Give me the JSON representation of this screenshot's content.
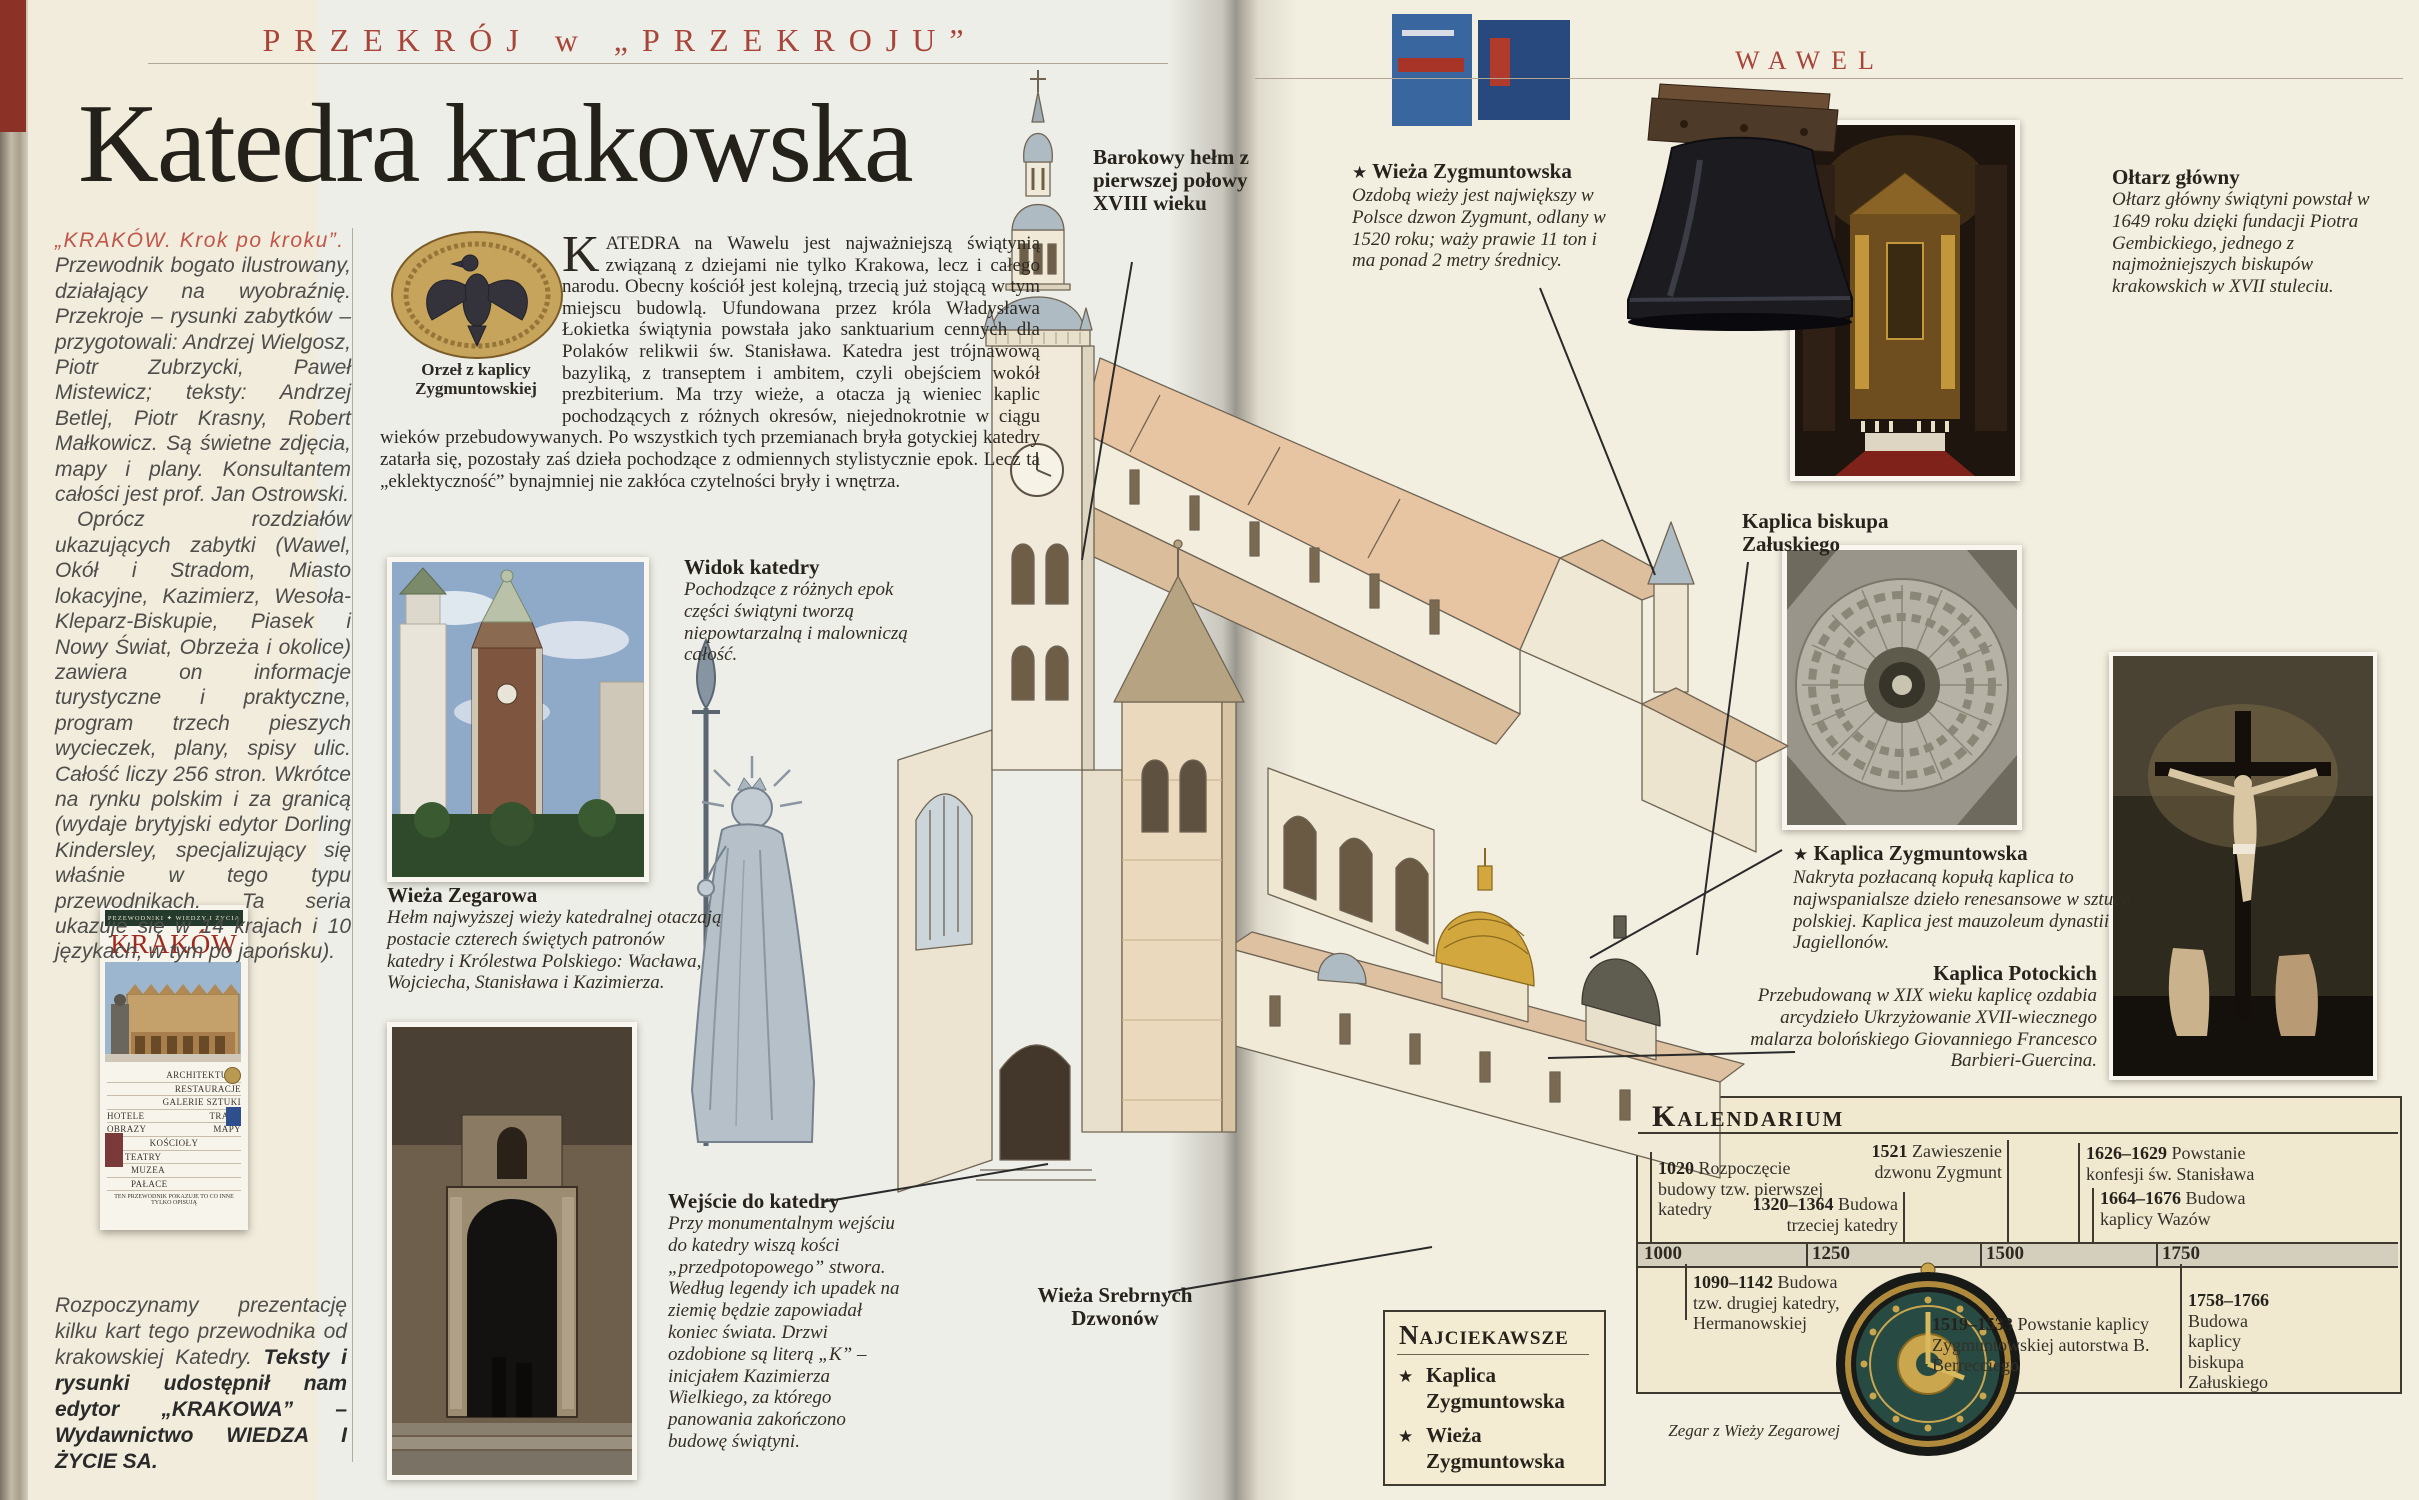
{
  "colors": {
    "masthead_red": "#a8453a",
    "lead_red": "#c0574a",
    "gold_dome": "#d2a83e",
    "kal_bg": "#f0e9d0"
  },
  "masthead": {
    "left": "PRZEKRÓJ w „PRZEKROJU”",
    "right": "WAWEL"
  },
  "title": "Katedra krakowska",
  "review": {
    "lead": "„KRAKÓW. Krok po kroku”.",
    "para1": "Przewodnik bogato ilustrowany, działający na wyobraźnię. Przekroje – rysunki zabytków – przygotowali: Andrzej Wielgosz, Piotr Zubrzycki, Paweł Mistewicz; teksty: Andrzej Betlej, Piotr Krasny, Robert Małkowicz. Są świetne zdjęcia, mapy i plany. Konsultantem całości jest prof. Jan Ostrowski.",
    "para2": "Oprócz rozdziałów ukazujących zabytki (Wawel, Okół i Stradom, Miasto lokacyjne, Kazimierz, Wesoła-Kleparz-Biskupie, Piasek i Nowy Świat, Obrzeża i okolice) zawiera on informacje turystyczne i praktyczne, program trzech pieszych wycieczek, plany, spisy ulic. Całość liczy 256 stron. Wkrótce na rynku polskim i za granicą (wydaje brytyjski edytor Dorling Kindersley, specjalizujący się właśnie w tego typu przewodnikach. Ta seria ukazuje się w 14 krajach i 10 językach, w tym po japońsku).",
    "footer_plain": "Rozpoczynamy prezentację kilku kart tego przewodnika od krakowskiej Katedry. ",
    "footer_bold": "Teksty i rysunki udostępnił nam edytor „KRAKOWA” – Wydawnictwo WIEDZA I ŻYCIE SA."
  },
  "cover": {
    "series": "PRZEWODNIKI ✦ WIEDZY I ŻYCIA",
    "title": "KRAKÓW",
    "keywords": [
      "ARCHITEKTURA",
      "RESTAURACJE",
      "GALERIE SZTUKI",
      "HOTELE",
      "TRASY",
      "OBRAZY",
      "MAPY",
      "KOŚCIOŁY",
      "TEATRY",
      "MUZEA",
      "PAŁACE"
    ],
    "tagline": "TEN PRZEWODNIK POKAZUJE TO CO INNE TYLKO OPISUJĄ"
  },
  "intro": {
    "dropcap": "K",
    "text": "ATEDRA na Wawelu jest najważniejszą świątynią związaną z dziejami nie tylko Krakowa, lecz i całego narodu. Obecny kościół jest kolejną, trzecią już stojącą w tym miejscu budowlą. Ufundowana przez króla Władysława Łokietka świątynia powstała jako sanktuarium cennych dla Polaków relikwii św. Stanisława. Katedra jest trójnawową bazyliką, z transeptem i ambitem, czyli obejściem wokół prezbiterium. Ma trzy wieże, a otacza ją wieniec kaplic pochodzących z różnych okresów, niejednokrotnie w ciągu wieków przebudowywanych. Po wszystkich tych przemianach bryła gotyckiej katedry zatarła się, pozostały zaś dzieła pochodzące z odmiennych stylistycznie epok. Lecz ta „eklektyczność” bynajmniej nie zakłóca czytelności bryły i wnętrza."
  },
  "star": "★",
  "captions": {
    "eagle": "Orzeł z kaplicy Zygmuntowskiej",
    "widok": {
      "title": "Widok katedry",
      "body": "Pochodzące z różnych epok części świątyni tworzą niepowtarzalną i malowniczą całość."
    },
    "wieza_zegarowa": {
      "title": "Wieża Zegarowa",
      "body": "Hełm najwyższej wieży katedralnej otaczają postacie czterech świętych patronów katedry i Królestwa Polskiego: Wacława, Wojciecha, Stanisława i Kazimierza."
    },
    "wejscie": {
      "title": "Wejście do katedry",
      "body": "Przy monumentalnym wejściu do katedry wiszą kości „przedpotopowego” stwora. Według legendy ich upadek na ziemię będzie zapowiadał koniec świata. Drzwi ozdobione są literą „K” – inicjałem Kazimierza Wielkiego, za którego panowania zakończono budowę świątyni."
    },
    "barokowy_helm": "Barokowy hełm z pierwszej połowy XVIII wieku",
    "wieza_zygmuntowska": {
      "title": "Wieża Zygmuntowska",
      "body": "Ozdobą wieży jest największy w Polsce dzwon Zygmunt, odlany w 1520 roku; waży prawie 11 ton i ma ponad 2 metry średnicy."
    },
    "kaplica_zaluskiego": "Kaplica biskupa Załuskiego",
    "oltarz": {
      "title": "Ołtarz główny",
      "body": "Ołtarz główny świątyni powstał w 1649 roku dzięki fundacji Piotra Gembickiego, jednego z najmożniejszych biskupów krakowskich w XVII stuleciu."
    },
    "kaplica_zygmuntowska": {
      "title": "Kaplica Zygmuntowska",
      "body": "Nakryta pozłacaną kopułą kaplica to najwspanialsze dzieło renesansowe w sztuce polskiej. Kaplica jest mauzoleum dynastii Jagiellonów."
    },
    "kaplica_potockich": {
      "title": "Kaplica Potockich",
      "body": "Przebudowaną w XIX wieku kaplicę ozdabia arcydzieło Ukrzyżowanie XVII-wiecznego malarza bolońskiego Giovanniego Francesco Barbieri-Guercina."
    },
    "wieza_srebrnych": "Wieża Srebrnych Dzwonów",
    "zegar": "Zegar z Wieży Zegarowej"
  },
  "kalendarium": {
    "title": "Kalendarium",
    "axis_years": [
      "1000",
      "1250",
      "1500",
      "1750"
    ],
    "events_above": [
      {
        "year": "1020",
        "text": "Rozpoczęcie budowy tzw. pierwszej katedry"
      },
      {
        "year": "1320–1364",
        "text": "Budowa trzeciej katedry"
      },
      {
        "year": "1521",
        "text": "Zawieszenie dzwonu Zygmunt"
      },
      {
        "year": "1626–1629",
        "text": "Powstanie konfesji św. Stanisława"
      },
      {
        "year": "1664–1676",
        "text": "Budowa kaplicy Wazów"
      }
    ],
    "events_below": [
      {
        "year": "1090–1142",
        "text": "Budowa tzw. drugiej katedry, Hermanowskiej"
      },
      {
        "year": "1519–1533",
        "text": "Powstanie kaplicy Zygmuntowskiej autorstwa B. Berrecciego"
      },
      {
        "year": "1758–1766",
        "text": "Budowa kaplicy biskupa Załuskiego"
      }
    ]
  },
  "najciekawsze": {
    "title": "Najciekawsze",
    "items": [
      "Kaplica Zygmuntowska",
      "Wieża Zygmuntowska"
    ]
  }
}
